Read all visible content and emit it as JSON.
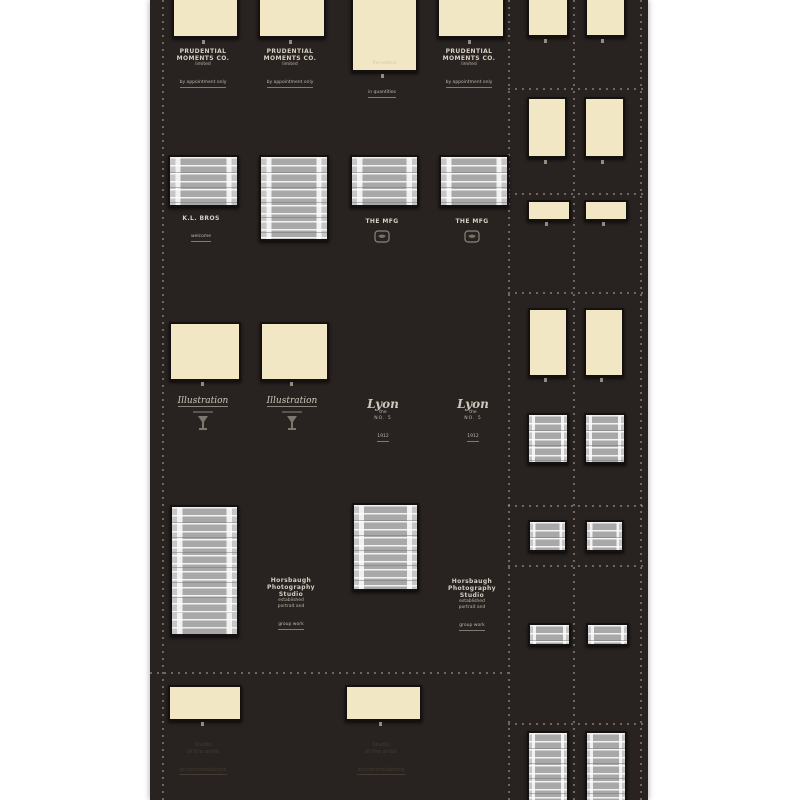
{
  "colors": {
    "page_bg": "#ffffff",
    "poster_bg": "#282220",
    "cream_swatch": "#f2e7c4",
    "plaid_gray": "#a8a8a8",
    "label_text": "#d6cfc2",
    "faint_text": "#453b32",
    "perforation_dash": "#b6ac9e"
  },
  "main": {
    "row1": {
      "ad_label": {
        "lines": [
          "PRUDENTIAL",
          "MOMENTS CO.",
          "limited",
          "by appointment only"
        ]
      },
      "tall_inner_caption": "the edition",
      "tall_caption": "in quantities"
    },
    "row2": {
      "label_a": {
        "lines": [
          "K.L. BROS",
          "welcome"
        ]
      },
      "label_b": {
        "line": "THE MFG"
      }
    },
    "row3": {
      "script_label": "Illustration",
      "logo": {
        "word": "Lyon",
        "the": "the",
        "caps": "NO. 5",
        "year": "1912"
      }
    },
    "row4": {
      "studio_block": {
        "lines": [
          "Horsbaugh",
          "Photography",
          "Studio",
          "established",
          "portrait and",
          "group work"
        ]
      }
    },
    "row5": {
      "faint_label": {
        "lines": [
          "Studio",
          "of the artist",
          "accommodations"
        ]
      }
    }
  }
}
